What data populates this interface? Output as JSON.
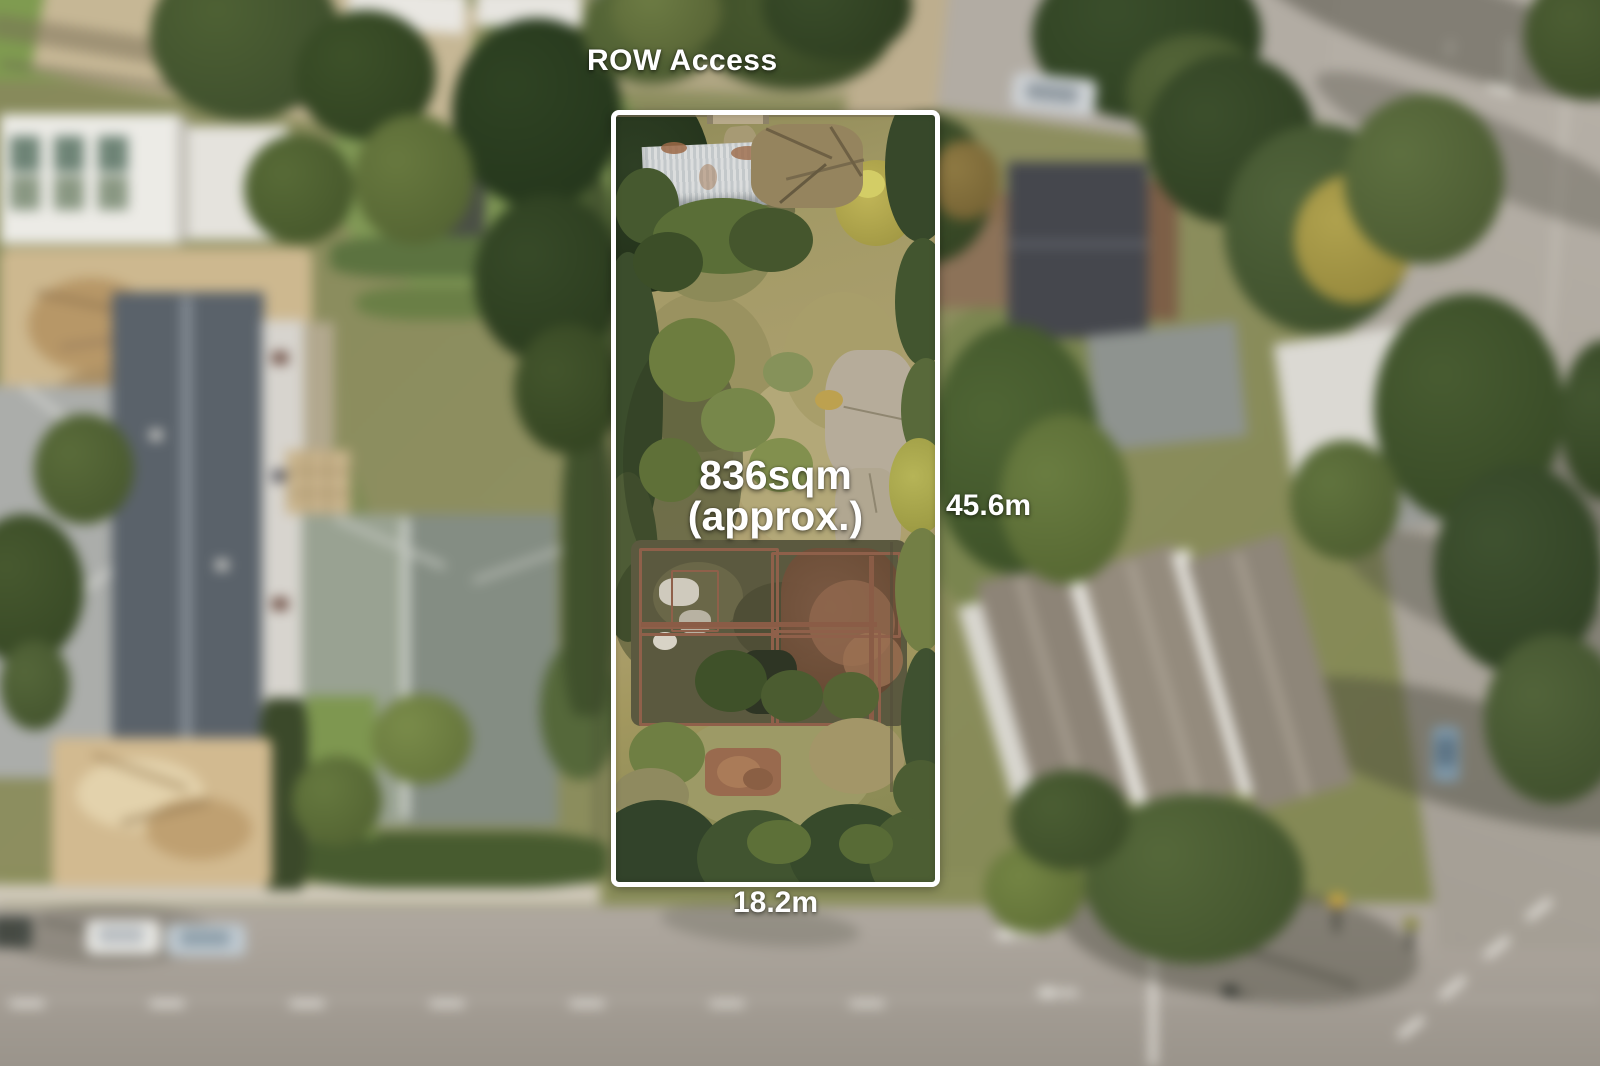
{
  "annotations": {
    "row_access": "ROW Access",
    "area": "836sqm",
    "area_qualifier": "(approx.)",
    "side_depth": "45.6m",
    "front_width": "18.2m"
  },
  "boundary": {
    "stroke_color": "#ffffff",
    "shape": "rectangle"
  },
  "palette": {
    "label_text": "#ffffff",
    "road": "#a8a29a",
    "foliage_dark": "#3d5129",
    "lot_field": "#a89c6c"
  }
}
